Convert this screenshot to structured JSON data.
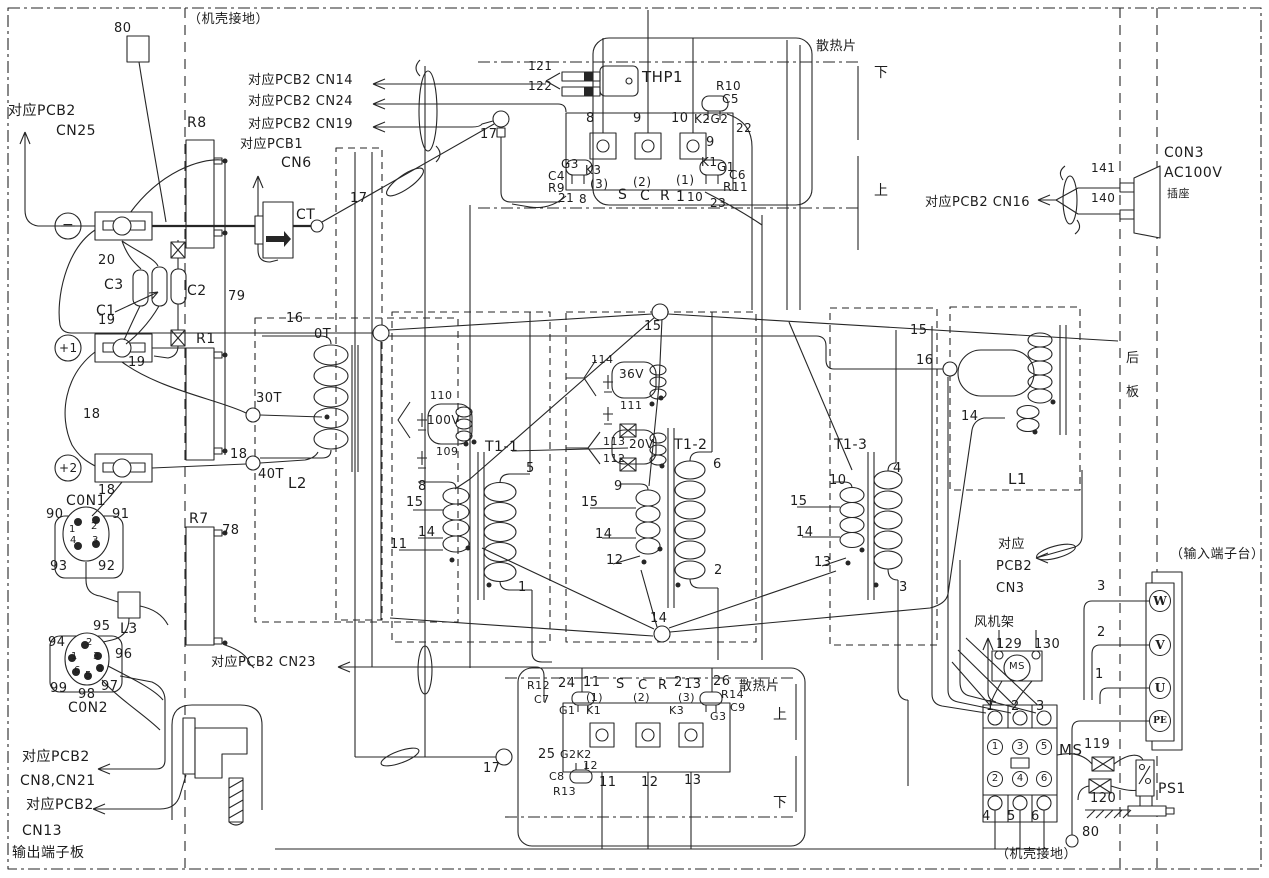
{
  "title": "inverter wiring schematic",
  "colors": {
    "ink": "#262626",
    "background": "#ffffff"
  },
  "labels": [
    {
      "i": "wire-80-top",
      "t": "80",
      "x": 114,
      "y": 22
    },
    {
      "i": "chassis-ground-top",
      "t": "（机壳接地）",
      "x": 188,
      "y": 13
    },
    {
      "i": "pcb2-cn25-line1",
      "t": "对应PCB2",
      "x": 8,
      "y": 104,
      "s": 14
    },
    {
      "i": "pcb2-cn25-line2",
      "t": "CN25",
      "x": 56,
      "y": 124,
      "s": 14
    },
    {
      "i": "pcb2-cn14",
      "t": "对应PCB2 CN14",
      "x": 248,
      "y": 74,
      "s": 13
    },
    {
      "i": "pcb2-cn24",
      "t": "对应PCB2 CN24",
      "x": 248,
      "y": 95,
      "s": 13
    },
    {
      "i": "pcb2-cn19",
      "t": "对应PCB2 CN19",
      "x": 248,
      "y": 118,
      "s": 13
    },
    {
      "i": "pcb1-cn6-line1",
      "t": "对应PCB1",
      "x": 240,
      "y": 138,
      "s": 13
    },
    {
      "i": "pcb1-cn6-line2",
      "t": "CN6",
      "x": 281,
      "y": 156,
      "s": 14
    },
    {
      "i": "resistor-r8",
      "t": "R8",
      "x": 187,
      "y": 116,
      "s": 14
    },
    {
      "i": "ct-label",
      "t": "CT",
      "x": 296,
      "y": 208,
      "s": 14
    },
    {
      "i": "wire-17-a",
      "t": "17",
      "x": 350,
      "y": 192
    },
    {
      "i": "wire-17-b",
      "t": "17",
      "x": 480,
      "y": 128
    },
    {
      "i": "thp1",
      "t": "THP1",
      "x": 642,
      "y": 70,
      "s": 15
    },
    {
      "i": "wire-121",
      "t": "121",
      "x": 528,
      "y": 60,
      "s": 12
    },
    {
      "i": "wire-122",
      "t": "122",
      "x": 528,
      "y": 80,
      "s": 12
    },
    {
      "i": "heatsink-top",
      "t": "散热片",
      "x": 816,
      "y": 40
    },
    {
      "i": "heatsink-top-lower",
      "t": "下",
      "x": 874,
      "y": 66,
      "s": 14
    },
    {
      "i": "heatsink-top-upper",
      "t": "上",
      "x": 874,
      "y": 184,
      "s": 14
    },
    {
      "i": "scr1-pin8",
      "t": "8",
      "x": 586,
      "y": 112
    },
    {
      "i": "scr1-pin9",
      "t": "9",
      "x": 633,
      "y": 112
    },
    {
      "i": "scr1-pin10",
      "t": "10",
      "x": 671,
      "y": 112
    },
    {
      "i": "r10",
      "t": "R10",
      "x": 716,
      "y": 80,
      "s": 12
    },
    {
      "i": "c5",
      "t": "C5",
      "x": 722,
      "y": 93,
      "s": 12
    },
    {
      "i": "k2g2",
      "t": "K2G2",
      "x": 694,
      "y": 113,
      "s": 12
    },
    {
      "i": "wire-22",
      "t": "22",
      "x": 736,
      "y": 122,
      "s": 12
    },
    {
      "i": "scr1-9b",
      "t": "9",
      "x": 706,
      "y": 136
    },
    {
      "i": "scr1-g3",
      "t": "G3",
      "x": 561,
      "y": 158,
      "s": 12
    },
    {
      "i": "scr1-k3",
      "t": "K3",
      "x": 585,
      "y": 164,
      "s": 12
    },
    {
      "i": "c4",
      "t": "C4",
      "x": 548,
      "y": 170,
      "s": 12
    },
    {
      "i": "r9",
      "t": "R9",
      "x": 548,
      "y": 182,
      "s": 12
    },
    {
      "i": "wire-21",
      "t": "21",
      "x": 558,
      "y": 192,
      "s": 12
    },
    {
      "i": "wire-8b",
      "t": "8",
      "x": 579,
      "y": 193,
      "s": 12
    },
    {
      "i": "scr1-ph3",
      "t": "(3)",
      "x": 590,
      "y": 178,
      "s": 12
    },
    {
      "i": "scr1-ph2",
      "t": "(2)",
      "x": 633,
      "y": 176,
      "s": 12
    },
    {
      "i": "scr1-ph1",
      "t": "(1)",
      "x": 676,
      "y": 174,
      "s": 12
    },
    {
      "i": "scr1-s",
      "t": "S",
      "x": 618,
      "y": 188,
      "s": 14
    },
    {
      "i": "scr1-c",
      "t": "C",
      "x": 640,
      "y": 189,
      "s": 14
    },
    {
      "i": "scr1-r",
      "t": "R",
      "x": 660,
      "y": 189,
      "s": 14
    },
    {
      "i": "scr1-1",
      "t": "1",
      "x": 676,
      "y": 190,
      "s": 14
    },
    {
      "i": "wire-10b",
      "t": "10",
      "x": 687,
      "y": 191,
      "s": 12
    },
    {
      "i": "wire-23",
      "t": "23",
      "x": 710,
      "y": 197,
      "s": 12
    },
    {
      "i": "scr1-k1",
      "t": "K1",
      "x": 701,
      "y": 156,
      "s": 12
    },
    {
      "i": "scr1-g1",
      "t": "G1",
      "x": 717,
      "y": 161,
      "s": 12
    },
    {
      "i": "c6",
      "t": "C6",
      "x": 729,
      "y": 169,
      "s": 12
    },
    {
      "i": "r11",
      "t": "R11",
      "x": 723,
      "y": 181,
      "s": 12
    },
    {
      "i": "pcb2-cn16",
      "t": "对应PCB2 CN16",
      "x": 925,
      "y": 196,
      "s": 13
    },
    {
      "i": "wire-141",
      "t": "141",
      "x": 1091,
      "y": 162,
      "s": 12
    },
    {
      "i": "wire-140",
      "t": "140",
      "x": 1091,
      "y": 192,
      "s": 12
    },
    {
      "i": "con3-line1",
      "t": "C0N3",
      "x": 1164,
      "y": 146,
      "s": 14
    },
    {
      "i": "con3-line2",
      "t": "AC100V",
      "x": 1164,
      "y": 166,
      "s": 14
    },
    {
      "i": "con3-line3",
      "t": "插座",
      "x": 1167,
      "y": 188,
      "s": 11
    },
    {
      "i": "rear-panel-1",
      "t": "后",
      "x": 1126,
      "y": 352
    },
    {
      "i": "rear-panel-2",
      "t": "板",
      "x": 1126,
      "y": 386
    },
    {
      "i": "wire-20",
      "t": "20",
      "x": 98,
      "y": 254
    },
    {
      "i": "c3",
      "t": "C3",
      "x": 104,
      "y": 278,
      "s": 14
    },
    {
      "i": "c1",
      "t": "C1",
      "x": 96,
      "y": 304,
      "s": 14
    },
    {
      "i": "c2",
      "t": "C2",
      "x": 187,
      "y": 284,
      "s": 14
    },
    {
      "i": "wire-19a",
      "t": "19",
      "x": 98,
      "y": 314
    },
    {
      "i": "wire-19b",
      "t": "19",
      "x": 128,
      "y": 356
    },
    {
      "i": "wire-18a",
      "t": "18",
      "x": 83,
      "y": 408
    },
    {
      "i": "wire-18b",
      "t": "18",
      "x": 98,
      "y": 484
    },
    {
      "i": "resistor-r1",
      "t": "R1",
      "x": 196,
      "y": 332,
      "s": 14
    },
    {
      "i": "wire-79",
      "t": "79",
      "x": 228,
      "y": 290
    },
    {
      "i": "tap-30t",
      "t": "30T",
      "x": 256,
      "y": 392
    },
    {
      "i": "wire-18c",
      "t": "18",
      "x": 230,
      "y": 448
    },
    {
      "i": "tap-40t",
      "t": "40T",
      "x": 258,
      "y": 468
    },
    {
      "i": "l2",
      "t": "L2",
      "x": 288,
      "y": 476,
      "s": 15
    },
    {
      "i": "wire-16a",
      "t": "16",
      "x": 286,
      "y": 312
    },
    {
      "i": "tap-0t",
      "t": "0T",
      "x": 314,
      "y": 328
    },
    {
      "i": "con1",
      "t": "C0N1",
      "x": 66,
      "y": 494,
      "s": 14
    },
    {
      "i": "con1-90",
      "t": "90",
      "x": 46,
      "y": 508
    },
    {
      "i": "con1-91",
      "t": "91",
      "x": 112,
      "y": 508
    },
    {
      "i": "con1-p1",
      "t": "1",
      "x": 69,
      "y": 525,
      "s": 10
    },
    {
      "i": "con1-p2",
      "t": "2",
      "x": 91,
      "y": 522,
      "s": 10
    },
    {
      "i": "con1-p4",
      "t": "4",
      "x": 70,
      "y": 536,
      "s": 10
    },
    {
      "i": "con1-p3",
      "t": "3",
      "x": 92,
      "y": 536,
      "s": 10
    },
    {
      "i": "con1-93",
      "t": "93",
      "x": 50,
      "y": 560
    },
    {
      "i": "con1-92",
      "t": "92",
      "x": 98,
      "y": 560
    },
    {
      "i": "resistor-r7",
      "t": "R7",
      "x": 189,
      "y": 512,
      "s": 14
    },
    {
      "i": "wire-78",
      "t": "78",
      "x": 222,
      "y": 524
    },
    {
      "i": "l3",
      "t": "L3",
      "x": 120,
      "y": 622,
      "s": 14
    },
    {
      "i": "con2-95",
      "t": "95",
      "x": 93,
      "y": 620
    },
    {
      "i": "con2-94",
      "t": "94",
      "x": 48,
      "y": 636
    },
    {
      "i": "con2-96",
      "t": "96",
      "x": 115,
      "y": 648
    },
    {
      "i": "con2-p2",
      "t": "2",
      "x": 86,
      "y": 638,
      "s": 10
    },
    {
      "i": "con2-p1",
      "t": "1",
      "x": 71,
      "y": 652,
      "s": 10
    },
    {
      "i": "con2-p3",
      "t": "3",
      "x": 93,
      "y": 652,
      "s": 10
    },
    {
      "i": "con2-p6",
      "t": "6",
      "x": 74,
      "y": 666,
      "s": 10
    },
    {
      "i": "con2-p5",
      "t": "5",
      "x": 85,
      "y": 671,
      "s": 10
    },
    {
      "i": "con2-p4",
      "t": "4",
      "x": 97,
      "y": 665,
      "s": 10
    },
    {
      "i": "con2-99",
      "t": "99",
      "x": 50,
      "y": 682
    },
    {
      "i": "con2-98",
      "t": "98",
      "x": 78,
      "y": 688
    },
    {
      "i": "con2-97",
      "t": "97",
      "x": 101,
      "y": 680
    },
    {
      "i": "con2",
      "t": "C0N2",
      "x": 68,
      "y": 701,
      "s": 14
    },
    {
      "i": "pcb2-cn23",
      "t": "对应PCB2 CN23",
      "x": 211,
      "y": 656,
      "s": 13
    },
    {
      "i": "pcb2-cn8-line1",
      "t": "对应PCB2",
      "x": 22,
      "y": 750,
      "s": 14
    },
    {
      "i": "pcb2-cn8-line2",
      "t": "CN8,CN21",
      "x": 20,
      "y": 774,
      "s": 14
    },
    {
      "i": "pcb2-cn13-line1",
      "t": "对应PCB2",
      "x": 26,
      "y": 798,
      "s": 14
    },
    {
      "i": "pcb2-cn13-line2",
      "t": "CN13",
      "x": 22,
      "y": 824,
      "s": 14
    },
    {
      "i": "output-board",
      "t": "输出端子板",
      "x": 12,
      "y": 846,
      "s": 14
    },
    {
      "i": "wire-110",
      "t": "110",
      "x": 430,
      "y": 390,
      "s": 11
    },
    {
      "i": "winding-100v",
      "t": "100V",
      "x": 427,
      "y": 414,
      "s": 12
    },
    {
      "i": "wire-109",
      "t": "109",
      "x": 436,
      "y": 446,
      "s": 11
    },
    {
      "i": "t1-1",
      "t": "T1-1",
      "x": 485,
      "y": 440,
      "s": 14
    },
    {
      "i": "t11-5",
      "t": "5",
      "x": 526,
      "y": 462
    },
    {
      "i": "t11-8",
      "t": "8",
      "x": 418,
      "y": 480
    },
    {
      "i": "t11-15",
      "t": "15",
      "x": 406,
      "y": 496
    },
    {
      "i": "t11-14",
      "t": "14",
      "x": 418,
      "y": 526
    },
    {
      "i": "t11-11",
      "t": "11",
      "x": 390,
      "y": 538
    },
    {
      "i": "t11-1",
      "t": "1",
      "x": 518,
      "y": 581
    },
    {
      "i": "wire-114",
      "t": "114",
      "x": 591,
      "y": 354,
      "s": 11
    },
    {
      "i": "winding-36v",
      "t": "36V",
      "x": 619,
      "y": 368,
      "s": 12
    },
    {
      "i": "wire-111",
      "t": "111",
      "x": 620,
      "y": 400,
      "s": 11
    },
    {
      "i": "wire-113",
      "t": "113",
      "x": 603,
      "y": 436,
      "s": 11
    },
    {
      "i": "winding-20v",
      "t": "20V",
      "x": 629,
      "y": 438,
      "s": 12
    },
    {
      "i": "wire-112",
      "t": "112",
      "x": 603,
      "y": 453,
      "s": 11
    },
    {
      "i": "t1-2",
      "t": "T1-2",
      "x": 674,
      "y": 438,
      "s": 14
    },
    {
      "i": "t12-6",
      "t": "6",
      "x": 713,
      "y": 458
    },
    {
      "i": "t12-9",
      "t": "9",
      "x": 614,
      "y": 480
    },
    {
      "i": "t12-15",
      "t": "15",
      "x": 581,
      "y": 496
    },
    {
      "i": "t12-14",
      "t": "14",
      "x": 595,
      "y": 528
    },
    {
      "i": "t12-12",
      "t": "12",
      "x": 606,
      "y": 554
    },
    {
      "i": "t12-2",
      "t": "2",
      "x": 714,
      "y": 564
    },
    {
      "i": "junction-15",
      "t": "15",
      "x": 644,
      "y": 320
    },
    {
      "i": "wire-15r",
      "t": "15",
      "x": 910,
      "y": 324
    },
    {
      "i": "wire-16b",
      "t": "16",
      "x": 916,
      "y": 354
    },
    {
      "i": "t1-3",
      "t": "T1-3",
      "x": 834,
      "y": 438,
      "s": 14
    },
    {
      "i": "t13-10",
      "t": "10",
      "x": 829,
      "y": 474
    },
    {
      "i": "t13-4",
      "t": "4",
      "x": 893,
      "y": 462
    },
    {
      "i": "t13-15",
      "t": "15",
      "x": 790,
      "y": 495
    },
    {
      "i": "t13-14",
      "t": "14",
      "x": 796,
      "y": 526
    },
    {
      "i": "t13-13",
      "t": "13",
      "x": 814,
      "y": 556
    },
    {
      "i": "t13-3",
      "t": "3",
      "x": 899,
      "y": 581
    },
    {
      "i": "junction-14",
      "t": "14",
      "x": 650,
      "y": 612
    },
    {
      "i": "l1",
      "t": "L1",
      "x": 1008,
      "y": 472,
      "s": 15
    },
    {
      "i": "l1-14",
      "t": "14",
      "x": 961,
      "y": 410
    },
    {
      "i": "pcb2-cn3-line1",
      "t": "对应",
      "x": 998,
      "y": 538
    },
    {
      "i": "pcb2-cn3-line2",
      "t": "PCB2",
      "x": 996,
      "y": 560
    },
    {
      "i": "pcb2-cn3-line3",
      "t": "CN3",
      "x": 996,
      "y": 582
    },
    {
      "i": "fan-frame",
      "t": "风机架",
      "x": 974,
      "y": 616
    },
    {
      "i": "wire-129",
      "t": "129",
      "x": 996,
      "y": 638
    },
    {
      "i": "wire-130",
      "t": "130",
      "x": 1034,
      "y": 638
    },
    {
      "i": "ms-motor-label",
      "t": "MS",
      "x": 1009,
      "y": 662,
      "s": 10
    },
    {
      "i": "ms-top-1",
      "t": "1",
      "x": 986,
      "y": 700
    },
    {
      "i": "ms-top-2",
      "t": "2",
      "x": 1011,
      "y": 700
    },
    {
      "i": "ms-top-3",
      "t": "3",
      "x": 1036,
      "y": 700
    },
    {
      "i": "ms-contactor",
      "t": "MS",
      "x": 1059,
      "y": 743,
      "s": 15
    },
    {
      "i": "wire-119",
      "t": "119",
      "x": 1084,
      "y": 738
    },
    {
      "i": "wire-120",
      "t": "120",
      "x": 1090,
      "y": 792
    },
    {
      "i": "ps1",
      "t": "PS1",
      "x": 1158,
      "y": 782,
      "s": 14
    },
    {
      "i": "wire-80-bottom",
      "t": "80",
      "x": 1082,
      "y": 826
    },
    {
      "i": "chassis-ground-bottom",
      "t": "（机壳接地）",
      "x": 996,
      "y": 848
    },
    {
      "i": "input-board",
      "t": "（输入端子台）",
      "x": 1170,
      "y": 548
    },
    {
      "i": "wire-3",
      "t": "3",
      "x": 1097,
      "y": 580
    },
    {
      "i": "wire-2",
      "t": "2",
      "x": 1097,
      "y": 626
    },
    {
      "i": "wire-1",
      "t": "1",
      "x": 1095,
      "y": 668
    },
    {
      "i": "terminal-w",
      "t": "W",
      "x": 1149,
      "y": 590,
      "c": "circ c22"
    },
    {
      "i": "terminal-v",
      "t": "V",
      "x": 1149,
      "y": 634,
      "c": "circ c22"
    },
    {
      "i": "terminal-u",
      "t": "U",
      "x": 1149,
      "y": 677,
      "c": "circ c22"
    },
    {
      "i": "terminal-pe",
      "t": "PE",
      "x": 1149,
      "y": 710,
      "c": "circ c22 pe"
    },
    {
      "i": "ms-pole-1",
      "t": "1",
      "x": 987,
      "y": 739,
      "c": "circ c16"
    },
    {
      "i": "ms-pole-3",
      "t": "3",
      "x": 1012,
      "y": 739,
      "c": "circ c16"
    },
    {
      "i": "ms-pole-5",
      "t": "5",
      "x": 1036,
      "y": 739,
      "c": "circ c16"
    },
    {
      "i": "ms-pole-2",
      "t": "2",
      "x": 987,
      "y": 771,
      "c": "circ c16"
    },
    {
      "i": "ms-pole-4",
      "t": "4",
      "x": 1012,
      "y": 771,
      "c": "circ c16"
    },
    {
      "i": "ms-pole-6",
      "t": "6",
      "x": 1036,
      "y": 771,
      "c": "circ c16"
    },
    {
      "i": "ms-bot-4",
      "t": "4",
      "x": 982,
      "y": 810
    },
    {
      "i": "ms-bot-5",
      "t": "5",
      "x": 1007,
      "y": 810
    },
    {
      "i": "ms-bot-6",
      "t": "6",
      "x": 1031,
      "y": 810
    },
    {
      "i": "terminal-minus",
      "t": "−",
      "x": 62,
      "y": 218,
      "s": 14
    },
    {
      "i": "terminal-plus1",
      "t": "+1",
      "x": 59,
      "y": 342,
      "s": 12
    },
    {
      "i": "terminal-plus2",
      "t": "+2",
      "x": 59,
      "y": 462,
      "s": 12
    },
    {
      "i": "scr2-r12",
      "t": "R12",
      "x": 527,
      "y": 680,
      "s": 11
    },
    {
      "i": "scr2-c7",
      "t": "C7",
      "x": 534,
      "y": 694,
      "s": 11
    },
    {
      "i": "scr2-24",
      "t": "24",
      "x": 558,
      "y": 677
    },
    {
      "i": "scr2-11t",
      "t": "11",
      "x": 583,
      "y": 676
    },
    {
      "i": "scr2-s",
      "t": "S",
      "x": 616,
      "y": 678,
      "s": 13
    },
    {
      "i": "scr2-c",
      "t": "C",
      "x": 638,
      "y": 679,
      "s": 13
    },
    {
      "i": "scr2-r",
      "t": "R",
      "x": 658,
      "y": 679,
      "s": 13
    },
    {
      "i": "scr2-2",
      "t": "2",
      "x": 674,
      "y": 676,
      "s": 13
    },
    {
      "i": "scr2-13t",
      "t": "13",
      "x": 684,
      "y": 678
    },
    {
      "i": "scr2-26",
      "t": "26",
      "x": 713,
      "y": 675
    },
    {
      "i": "scr2-r14",
      "t": "R14",
      "x": 721,
      "y": 689,
      "s": 11
    },
    {
      "i": "scr2-c9",
      "t": "C9",
      "x": 730,
      "y": 702,
      "s": 11
    },
    {
      "i": "heatsink-bottom",
      "t": "散热片",
      "x": 739,
      "y": 680
    },
    {
      "i": "heatsink-bottom-upper",
      "t": "上",
      "x": 773,
      "y": 708,
      "s": 14
    },
    {
      "i": "heatsink-bottom-lower",
      "t": "下",
      "x": 773,
      "y": 796,
      "s": 14
    },
    {
      "i": "scr2-ph1",
      "t": "(1)",
      "x": 586,
      "y": 692,
      "s": 11
    },
    {
      "i": "scr2-ph2",
      "t": "(2)",
      "x": 633,
      "y": 692,
      "s": 11
    },
    {
      "i": "scr2-ph3",
      "t": "(3)",
      "x": 678,
      "y": 692,
      "s": 11
    },
    {
      "i": "scr2-g1",
      "t": "G1",
      "x": 559,
      "y": 705,
      "s": 11
    },
    {
      "i": "scr2-k1",
      "t": "K1",
      "x": 586,
      "y": 705,
      "s": 11
    },
    {
      "i": "scr2-k3",
      "t": "K3",
      "x": 669,
      "y": 705,
      "s": 11
    },
    {
      "i": "scr2-g3",
      "t": "G3",
      "x": 710,
      "y": 711,
      "s": 11
    },
    {
      "i": "scr2-25",
      "t": "25",
      "x": 538,
      "y": 748
    },
    {
      "i": "scr2-g2k2",
      "t": "G2K2",
      "x": 560,
      "y": 749,
      "s": 11
    },
    {
      "i": "scr2-12s",
      "t": "12",
      "x": 583,
      "y": 760,
      "s": 11
    },
    {
      "i": "scr2-c8",
      "t": "C8",
      "x": 549,
      "y": 771,
      "s": 11
    },
    {
      "i": "scr2-r13",
      "t": "R13",
      "x": 553,
      "y": 786,
      "s": 11
    },
    {
      "i": "scr2-11b",
      "t": "11",
      "x": 599,
      "y": 776
    },
    {
      "i": "scr2-12b",
      "t": "12",
      "x": 641,
      "y": 776
    },
    {
      "i": "scr2-13b",
      "t": "13",
      "x": 684,
      "y": 774
    },
    {
      "i": "wire-17-c",
      "t": "17",
      "x": 483,
      "y": 762
    }
  ]
}
